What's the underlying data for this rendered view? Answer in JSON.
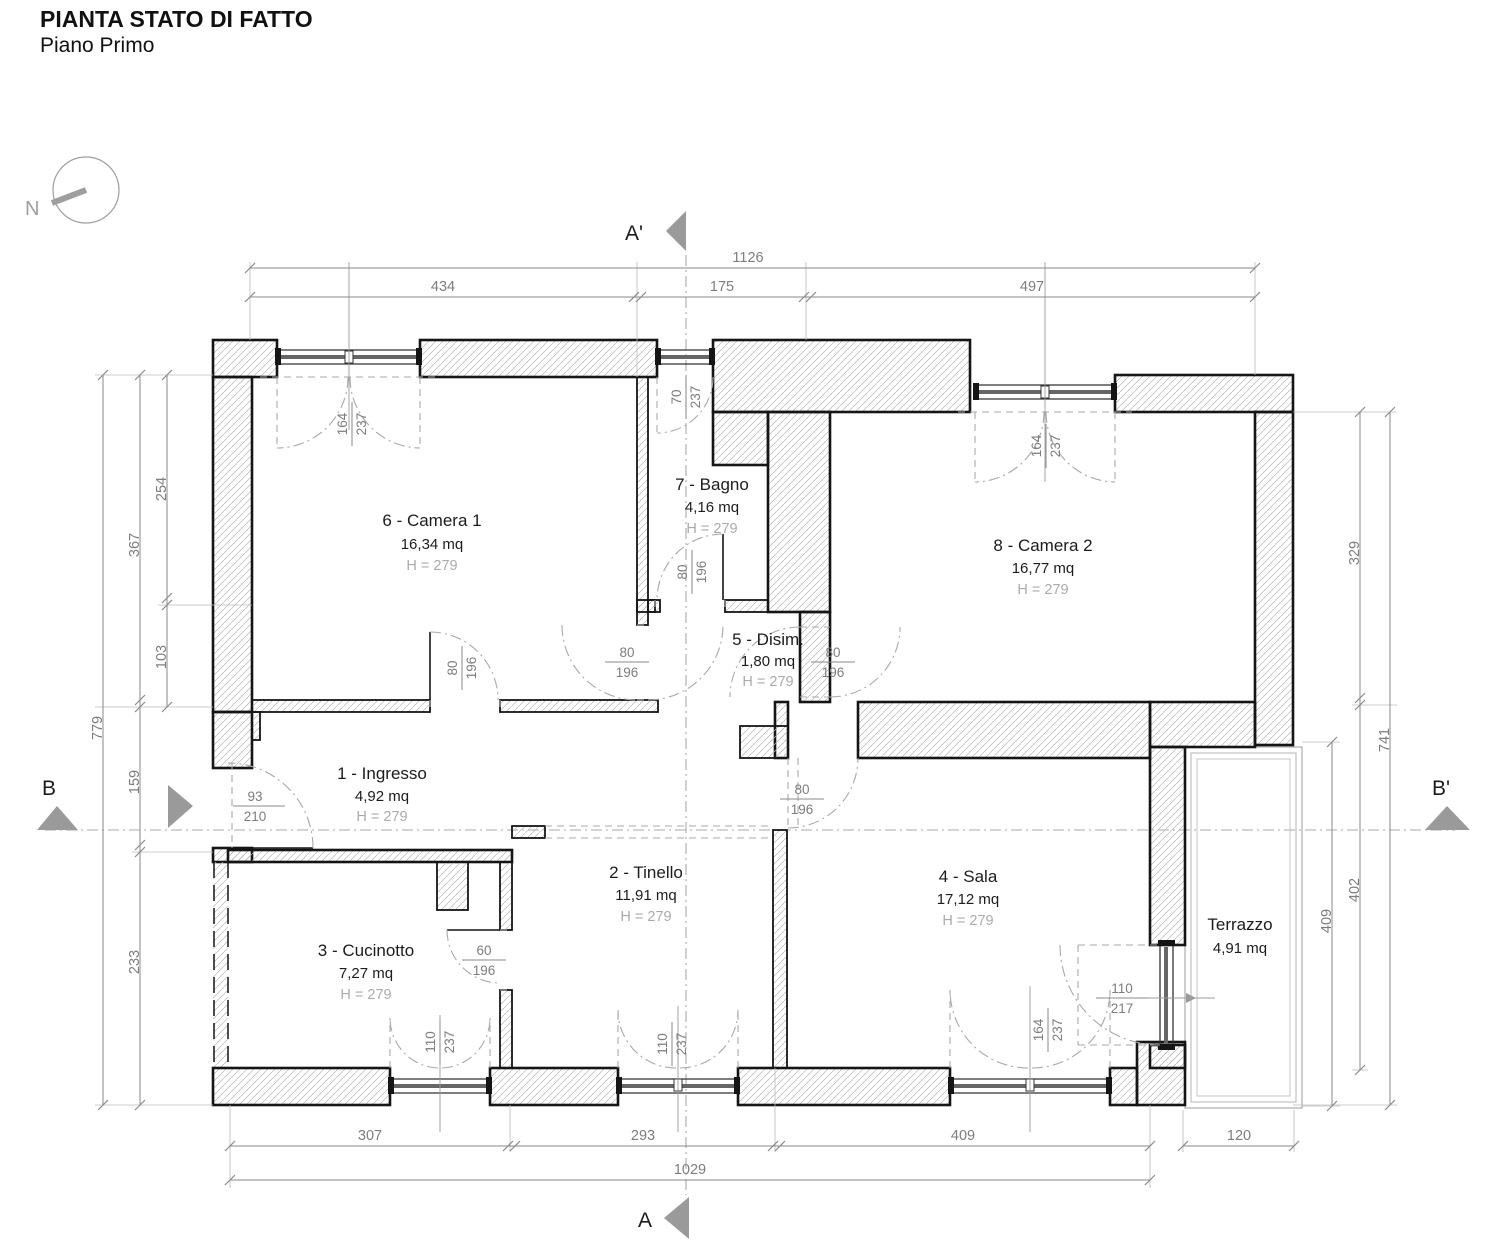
{
  "title": "PIANTA STATO DI FATTO",
  "subtitle": "Piano Primo",
  "north_label": "N",
  "sections": {
    "a": "A",
    "a_prime": "A'",
    "b": "B",
    "b_prime": "B'"
  },
  "rooms": [
    {
      "name": "1 - Ingresso",
      "area": "4,92 mq",
      "height": "H = 279"
    },
    {
      "name": "2 - Tinello",
      "area": "11,91 mq",
      "height": "H = 279"
    },
    {
      "name": "3 - Cucinotto",
      "area": "7,27 mq",
      "height": "H = 279"
    },
    {
      "name": "4 - Sala",
      "area": "17,12 mq",
      "height": "H = 279"
    },
    {
      "name": "5 - Disim.",
      "area": "1,80 mq",
      "height": "H = 279"
    },
    {
      "name": "6 - Camera 1",
      "area": "16,34 mq",
      "height": "H = 279"
    },
    {
      "name": "7 - Bagno",
      "area": "4,16 mq",
      "height": "H = 279"
    },
    {
      "name": "8 - Camera 2",
      "area": "16,77 mq",
      "height": "H = 279"
    },
    {
      "name": "Terrazzo",
      "area": "4,91 mq"
    }
  ],
  "dimensions": {
    "top": {
      "total": "1126",
      "seg": [
        "434",
        "175",
        "497"
      ]
    },
    "bottom": {
      "total": "1029",
      "seg": [
        "307",
        "293",
        "409",
        "120"
      ]
    },
    "left": {
      "outer": "779",
      "mid": [
        "367",
        "159",
        "233"
      ],
      "inner": [
        "254",
        "103"
      ]
    },
    "right": {
      "outer": "741",
      "mid": [
        "329",
        "402"
      ],
      "terrace": "409"
    }
  },
  "openings": {
    "win_camera1": {
      "w": "164",
      "h": "237"
    },
    "win_bagno": {
      "w": "70",
      "h": "237"
    },
    "win_camera2": {
      "w": "164",
      "h": "237"
    },
    "door_camera1": {
      "w": "80",
      "h": "196"
    },
    "door_corridoio": {
      "w": "80",
      "h": "196"
    },
    "door_bagno": {
      "w": "80",
      "h": "196"
    },
    "door_camera2": {
      "w": "80",
      "h": "196"
    },
    "door_sala": {
      "w": "80",
      "h": "196"
    },
    "door_ingresso": {
      "w": "93",
      "h": "210"
    },
    "door_cucinotto": {
      "w": "60",
      "h": "196"
    },
    "win_cucinotto": {
      "w": "110",
      "h": "237"
    },
    "win_tinello": {
      "w": "110",
      "h": "237"
    },
    "win_sala": {
      "w": "164",
      "h": "237"
    },
    "door_terrazzo": {
      "w": "110",
      "h": "217"
    }
  }
}
